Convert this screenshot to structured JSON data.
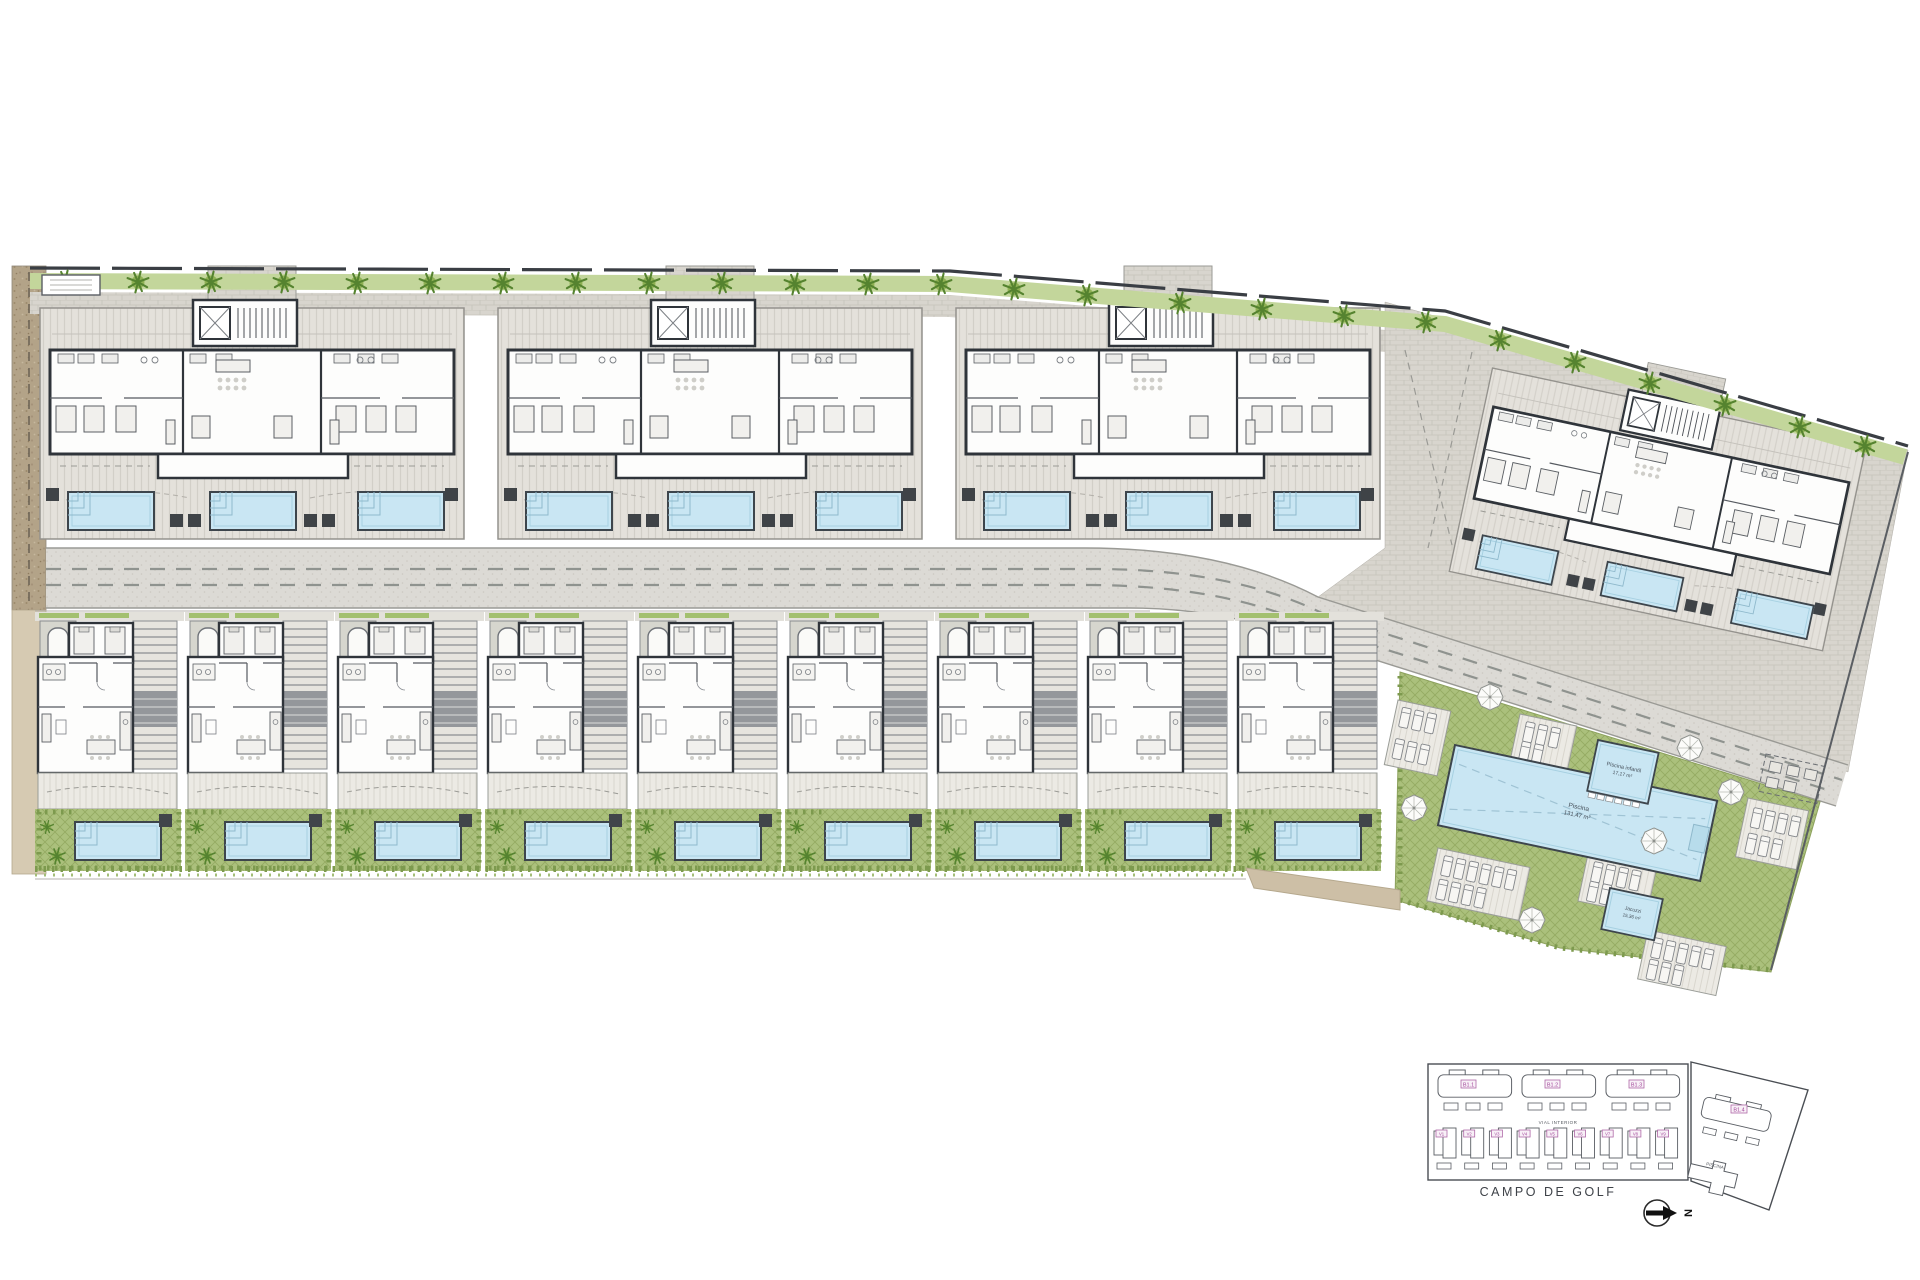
{
  "pool_complex": {
    "kids_pool": {
      "label": "Piscina infantil",
      "area": "17,17 m²"
    },
    "main_pool": {
      "label": "Piscina",
      "area": "131,47 m²"
    },
    "jacuzzi": {
      "label": "Jacuzzi",
      "area": "15,36 m²"
    }
  },
  "key_plan": {
    "buildings": [
      "B1.1",
      "B1.2",
      "B1.3"
    ],
    "building_4": "B1.4",
    "villas": [
      "V1",
      "V2",
      "V3",
      "V4",
      "V5",
      "V6",
      "V7",
      "V8",
      "V9"
    ],
    "road_label": "VIAL INTERIOR",
    "pool_label": "PISCINA",
    "golf_label": "CAMPO DE GOLF",
    "north_label": "N"
  },
  "colors": {
    "lawn": "#abc07c",
    "pool_water": "#c9e6f3",
    "hedge": "#7d9a4e",
    "paving": "#d8d5ce",
    "gravel": "#b3a388",
    "wall": "#2f343a",
    "label_pink": "#a2489a"
  }
}
